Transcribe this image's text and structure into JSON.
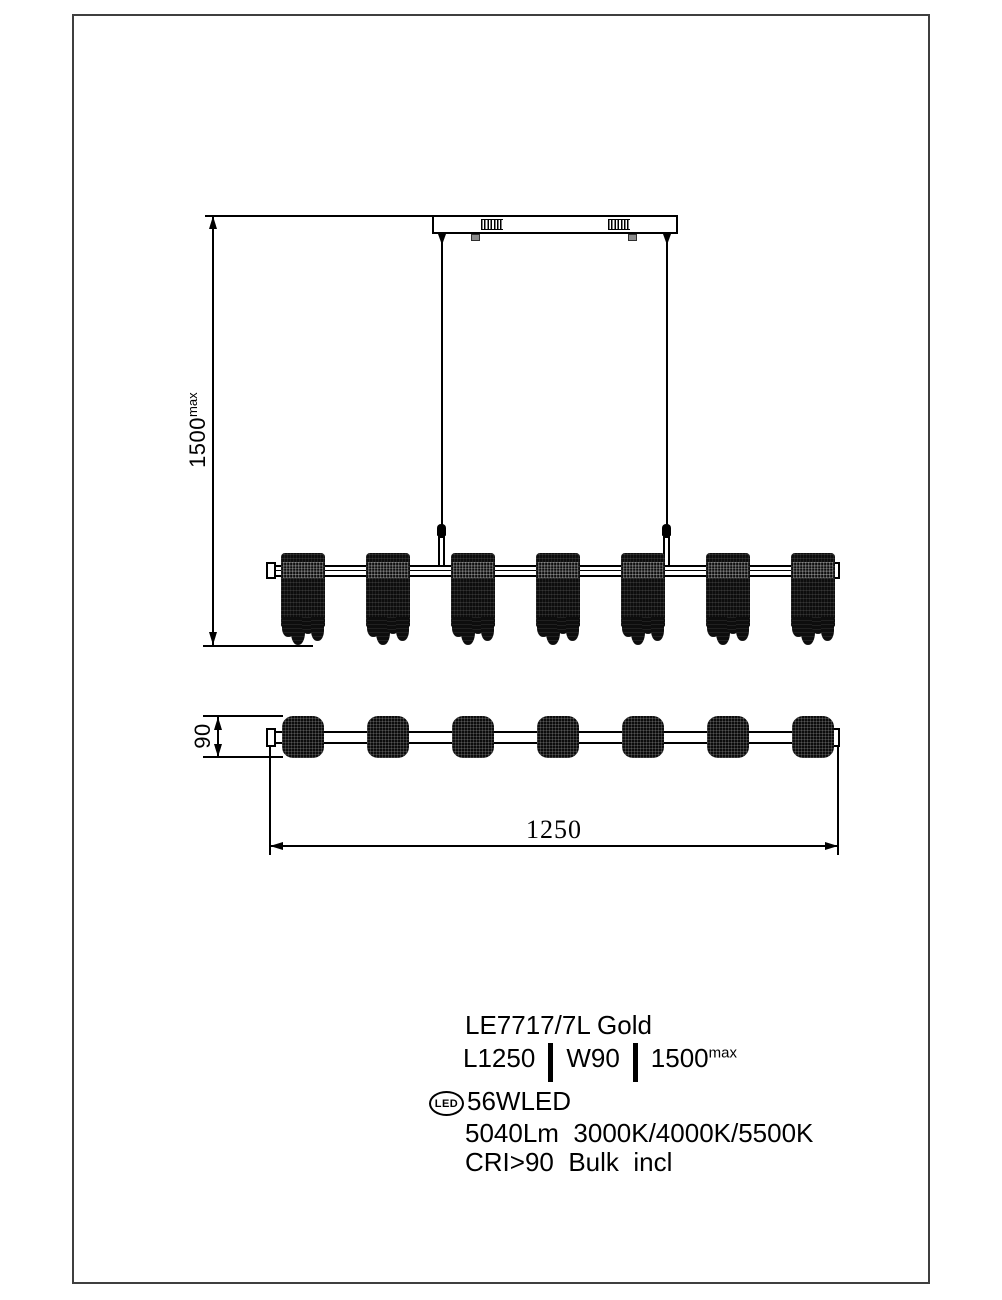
{
  "page": {
    "background": "#ffffff",
    "frame_color": "#3f3f3f",
    "line_color": "#000000"
  },
  "drawing": {
    "shade_count": 7,
    "dim_height": {
      "value": "1500",
      "sup": "max"
    },
    "dim_width": {
      "value": "90"
    },
    "dim_length": {
      "value": "1250"
    }
  },
  "specs": {
    "model": "LE7717/7L Gold",
    "length": "L1250",
    "width": "W90",
    "height": "1500",
    "height_sup": "max",
    "badge": "LED",
    "power": "56WLED",
    "lumens": "5040Lm  3000K/4000K/5500K",
    "cri": "CRI>90  Bulk  incl"
  }
}
